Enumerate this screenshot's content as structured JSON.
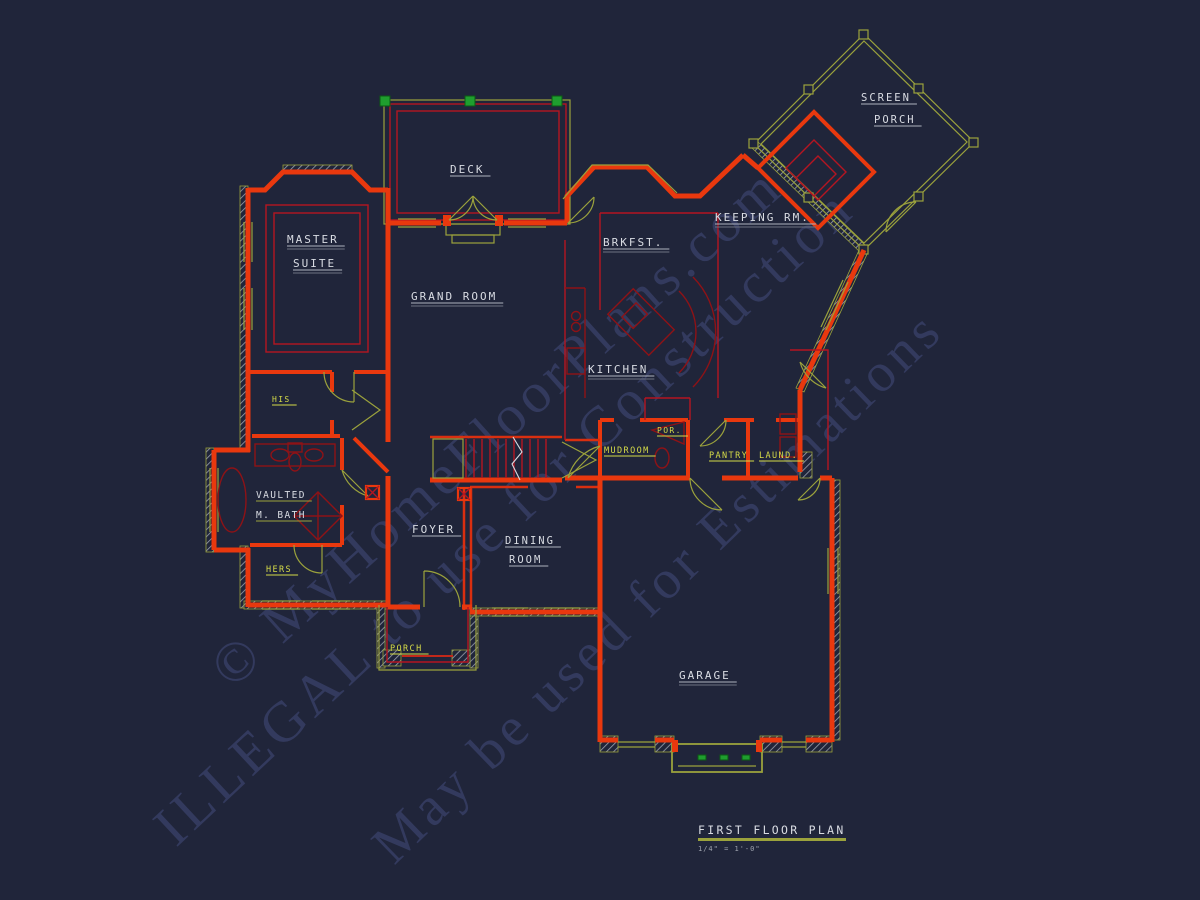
{
  "drawing": {
    "type": "architectural-floor-plan",
    "background": "#20253a",
    "colors": {
      "wall_red": "#e9380e",
      "interior_red": "#b51521",
      "furniture_red": "#8e1216",
      "trim_olive": "#9ba23c",
      "label_white": "#d9dce3",
      "label_yellow": "#d5db48",
      "deck_post_green": "#1f9e2e",
      "watermark": "#353c60"
    }
  },
  "watermark": {
    "lines": [
      {
        "name": "watermark-line-1",
        "text": "© MyHomeFloorPlans.com",
        "x": 232,
        "y": 690,
        "angle": -42,
        "size": 57
      },
      {
        "name": "watermark-line-2",
        "text": "ILLEGAL to use for Construction",
        "x": 176,
        "y": 848,
        "angle": -43,
        "size": 57
      },
      {
        "name": "watermark-line-3",
        "text": "May be used for Estimations",
        "x": 394,
        "y": 866,
        "angle": -44,
        "size": 55
      }
    ]
  },
  "labels": [
    {
      "name": "room-label-master-suite-1",
      "text": "MASTER",
      "x": 287,
      "y": 243,
      "fill": "#d9dce3",
      "ul": "#aeb3bf",
      "size": 11,
      "dbl": true
    },
    {
      "name": "room-label-master-suite-2",
      "text": "SUITE",
      "x": 293,
      "y": 267,
      "fill": "#d9dce3",
      "ul": "#aeb3bf",
      "size": 11,
      "dbl": true
    },
    {
      "name": "room-label-deck",
      "text": "DECK",
      "x": 450,
      "y": 173,
      "fill": "#d9dce3",
      "ul": "#aeb3bf",
      "size": 11,
      "dbl": false
    },
    {
      "name": "room-label-grand-room",
      "text": "GRAND ROOM",
      "x": 411,
      "y": 300,
      "fill": "#d9dce3",
      "ul": "#aeb3bf",
      "size": 11,
      "dbl": true
    },
    {
      "name": "room-label-brkfst",
      "text": "BRKFST.",
      "x": 603,
      "y": 246,
      "fill": "#d9dce3",
      "ul": "#aeb3bf",
      "size": 11,
      "dbl": true
    },
    {
      "name": "room-label-keeping-rm",
      "text": "KEEPING RM.",
      "x": 715,
      "y": 221,
      "fill": "#d9dce3",
      "ul": "#aeb3bf",
      "size": 11,
      "dbl": true
    },
    {
      "name": "room-label-screen-porch-1",
      "text": "SCREEN",
      "x": 861,
      "y": 101,
      "fill": "#d9dce3",
      "ul": "#aeb3bf",
      "size": 10.5,
      "dbl": false
    },
    {
      "name": "room-label-screen-porch-2",
      "text": "PORCH",
      "x": 874,
      "y": 123,
      "fill": "#d9dce3",
      "ul": "#aeb3bf",
      "size": 10.5,
      "dbl": false
    },
    {
      "name": "room-label-kitchen",
      "text": "KITCHEN",
      "x": 588,
      "y": 373,
      "fill": "#d9dce3",
      "ul": "#aeb3bf",
      "size": 11,
      "dbl": true
    },
    {
      "name": "room-label-master-bath-1",
      "text": "VAULTED",
      "x": 256,
      "y": 498,
      "fill": "#d9dce3",
      "ul": "#9ba23c",
      "size": 9.5,
      "dbl": false
    },
    {
      "name": "room-label-master-bath-2",
      "text": "M. BATH",
      "x": 256,
      "y": 518,
      "fill": "#d9dce3",
      "ul": "#9ba23c",
      "size": 9.5,
      "dbl": false
    },
    {
      "name": "room-label-his-closet",
      "text": "HIS",
      "x": 272,
      "y": 402,
      "fill": "#d5db48",
      "ul": "#d5db48",
      "size": 8,
      "dbl": false
    },
    {
      "name": "room-label-hers-closet",
      "text": "HERS",
      "x": 266,
      "y": 572,
      "fill": "#d5db48",
      "ul": "#d5db48",
      "size": 8.5,
      "dbl": false
    },
    {
      "name": "room-label-foyer",
      "text": "FOYER",
      "x": 412,
      "y": 533,
      "fill": "#d9dce3",
      "ul": "#aeb3bf",
      "size": 11,
      "dbl": false
    },
    {
      "name": "room-label-dining-1",
      "text": "DINING",
      "x": 505,
      "y": 544,
      "fill": "#d9dce3",
      "ul": "#aeb3bf",
      "size": 10.5,
      "dbl": false
    },
    {
      "name": "room-label-dining-2",
      "text": "ROOM",
      "x": 509,
      "y": 563,
      "fill": "#d9dce3",
      "ul": "#aeb3bf",
      "size": 10.5,
      "dbl": false
    },
    {
      "name": "room-label-front-porch",
      "text": "PORCH",
      "x": 390,
      "y": 651,
      "fill": "#d5db48",
      "ul": "#d5db48",
      "size": 8.5,
      "dbl": false
    },
    {
      "name": "room-label-mudroom",
      "text": "MUDROOM",
      "x": 604,
      "y": 453,
      "fill": "#d5db48",
      "ul": "#d5db48",
      "size": 8.5,
      "dbl": false
    },
    {
      "name": "room-label-powder",
      "text": "POR.",
      "x": 657,
      "y": 433,
      "fill": "#d5db48",
      "ul": "#d5db48",
      "size": 8,
      "dbl": false
    },
    {
      "name": "room-label-pantry",
      "text": "PANTRY",
      "x": 709,
      "y": 458,
      "fill": "#d5db48",
      "ul": "#d5db48",
      "size": 8.5,
      "dbl": false
    },
    {
      "name": "room-label-laundry",
      "text": "LAUND.",
      "x": 759,
      "y": 458,
      "fill": "#d5db48",
      "ul": "#d5db48",
      "size": 8.5,
      "dbl": false
    },
    {
      "name": "room-label-garage",
      "text": "GARAGE",
      "x": 679,
      "y": 679,
      "fill": "#d9dce3",
      "ul": "#aeb3bf",
      "size": 11,
      "dbl": true
    }
  ],
  "title_block": {
    "title": "FIRST FLOOR PLAN",
    "scale": "1/4\" = 1'-0\""
  }
}
